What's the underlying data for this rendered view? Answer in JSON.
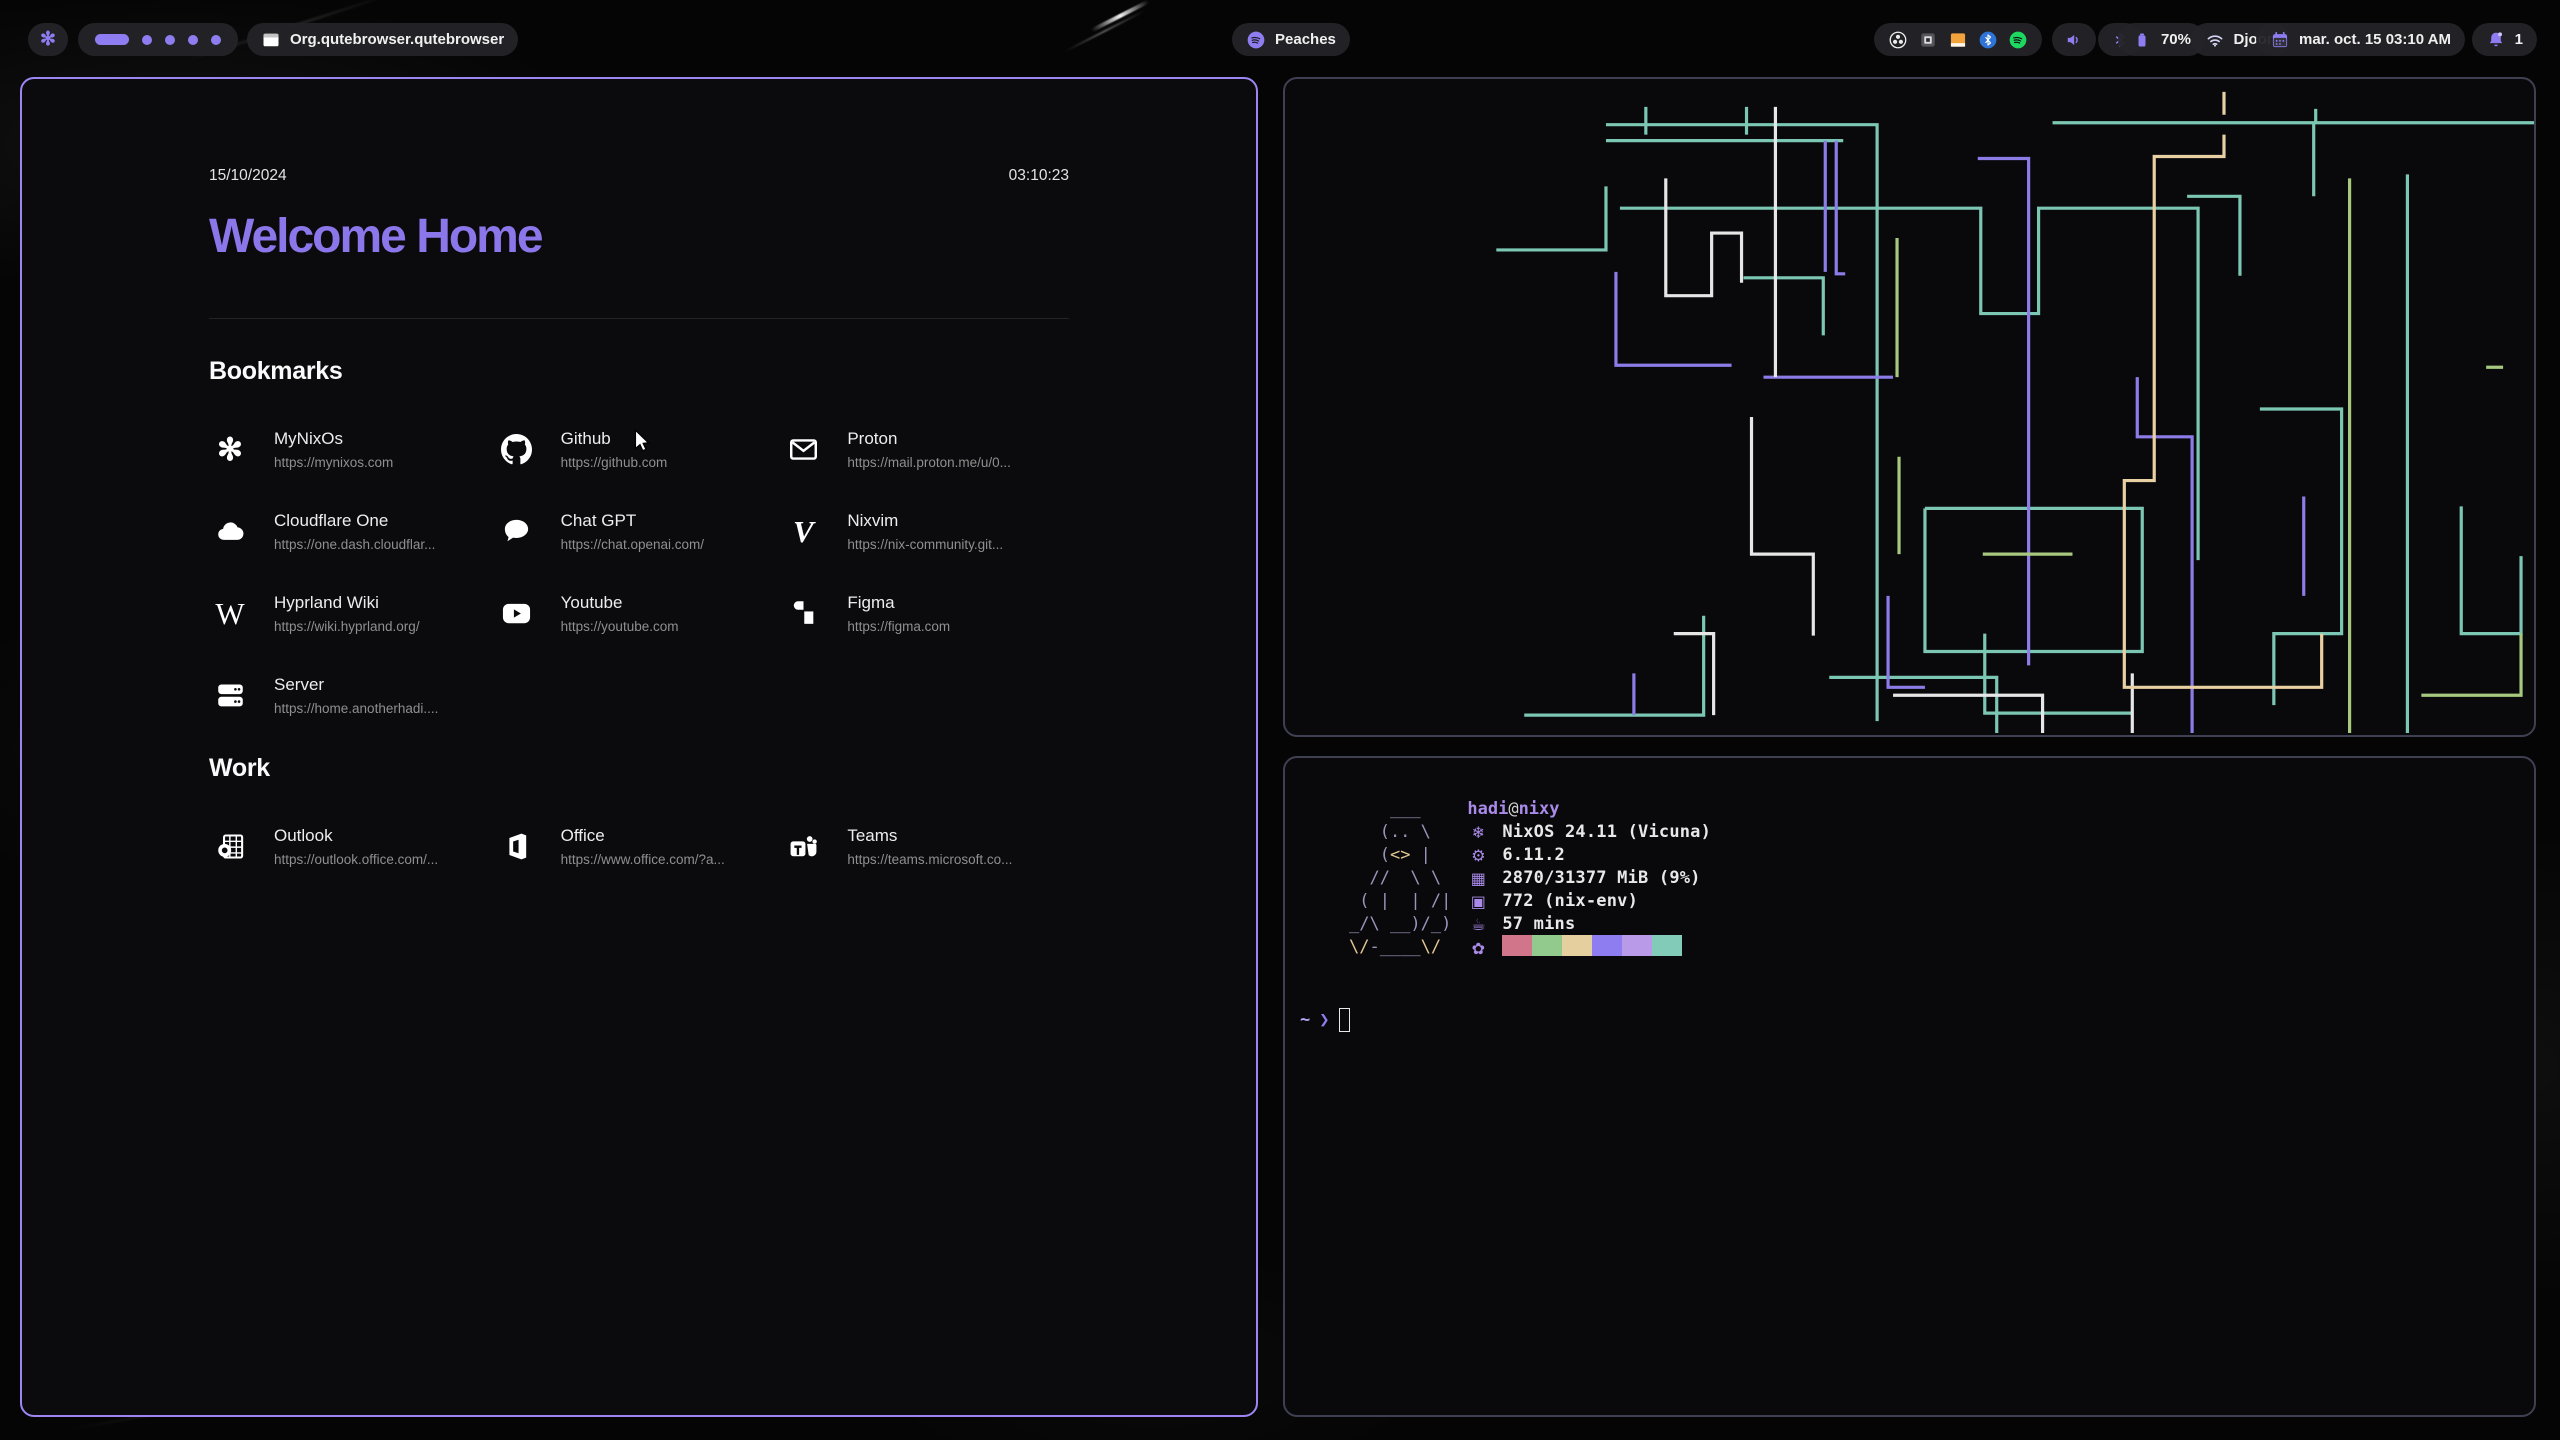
{
  "theme": {
    "accent": "#8d7df1",
    "title_purple": "#8b76ea",
    "window_border_active": "#9d86f3",
    "window_border_inactive": "#3f3f52",
    "pill_bg": "#242428",
    "pipe_colors": {
      "teal": "#7cc7b4",
      "purple": "#8b7ce8",
      "white": "#e6e6e6",
      "green": "#a6c97f",
      "tan": "#e8d0a2"
    }
  },
  "topbar": {
    "launcher": {
      "icon": "nixos-logo",
      "glyph": "✻"
    },
    "workspaces": {
      "active": 1,
      "total": 5
    },
    "window_title": "Org.qutebrowser.qutebrowser",
    "media": {
      "icon": "spotify",
      "label": "Peaches"
    },
    "tray": [
      "obs",
      "keyboard",
      "files",
      "bluetooth",
      "spotify"
    ],
    "battery": {
      "label": "70%"
    },
    "network": {
      "label": "Djoon"
    },
    "clock": {
      "label": "mar. oct. 15  03:10 AM"
    },
    "notifications": {
      "label": "1"
    }
  },
  "browser": {
    "date": "15/10/2024",
    "time": "03:10:23",
    "title": "Welcome Home",
    "sections": [
      {
        "title": "Bookmarks",
        "items": [
          {
            "name": "MyNixOs",
            "url": "https://mynixos.com",
            "icon": "nixos"
          },
          {
            "name": "Github",
            "url": "https://github.com",
            "icon": "github"
          },
          {
            "name": "Proton",
            "url": "https://mail.proton.me/u/0...",
            "icon": "envelope"
          },
          {
            "name": "Cloudflare One",
            "url": "https://one.dash.cloudflar...",
            "icon": "cloud"
          },
          {
            "name": "Chat GPT",
            "url": "https://chat.openai.com/",
            "icon": "chat-bubble"
          },
          {
            "name": "Nixvim",
            "url": "https://nix-community.git...",
            "icon": "nixvim-v"
          },
          {
            "name": "Hyprland Wiki",
            "url": "https://wiki.hyprland.org/",
            "icon": "wiki-w"
          },
          {
            "name": "Youtube",
            "url": "https://youtube.com",
            "icon": "youtube-play"
          },
          {
            "name": "Figma",
            "url": "https://figma.com",
            "icon": "figma"
          },
          {
            "name": "Server",
            "url": "https://home.anotherhadi....",
            "icon": "server"
          }
        ]
      },
      {
        "title": "Work",
        "items": [
          {
            "name": "Outlook",
            "url": "https://outlook.office.com/...",
            "icon": "outlook"
          },
          {
            "name": "Office",
            "url": "https://www.office.com/?a...",
            "icon": "office"
          },
          {
            "name": "Teams",
            "url": "https://teams.microsoft.co...",
            "icon": "teams"
          }
        ]
      }
    ]
  },
  "terminal": {
    "fetch": {
      "user": "hadi",
      "sep": "@",
      "host": "nixy",
      "rows": [
        {
          "key": "os",
          "icon": "❄",
          "text": "NixOS 24.11 (Vicuna)"
        },
        {
          "key": "kernel",
          "icon": "⚙",
          "text": "6.11.2"
        },
        {
          "key": "memory",
          "icon": "▦",
          "text": "2870/31377 MiB (9%)"
        },
        {
          "key": "packages",
          "icon": "▣",
          "text": "772 (nix-env)"
        },
        {
          "key": "uptime",
          "icon": "☕",
          "text": "57 mins"
        }
      ],
      "palette_icon": "✿",
      "palette": [
        "#d1758b",
        "#92c98c",
        "#e6cf9f",
        "#8d7df1",
        "#b89ae9",
        "#82cbb8"
      ],
      "ascii": [
        [
          {
            "t": "    ___",
            "c": "g"
          }
        ],
        [
          {
            "t": "   (.. \\",
            "c": "g"
          }
        ],
        [
          {
            "t": "   (",
            "c": "g"
          },
          {
            "t": "<>",
            "c": "y"
          },
          {
            "t": " |",
            "c": "g"
          }
        ],
        [
          {
            "t": "  //  \\ \\",
            "c": "g"
          }
        ],
        [
          {
            "t": " ( |  | /|",
            "c": "g"
          }
        ],
        [
          {
            "t": "_/\\ __)/_)",
            "c": "g"
          }
        ],
        [
          {
            "t": "\\/",
            "c": "y"
          },
          {
            "t": "-____",
            "c": "g"
          },
          {
            "t": "\\/",
            "c": "y"
          }
        ]
      ]
    },
    "prompt": {
      "path": "~",
      "symbol": "❯"
    }
  },
  "pipes": [
    {
      "c": "#7cc7b4",
      "d": "M322 46H594V646"
    },
    {
      "c": "#7cc7b4",
      "d": "M322 62H560"
    },
    {
      "c": "#7cc7b4",
      "d": "M212 172H322V108"
    },
    {
      "c": "#7cc7b4",
      "d": "M336 130H698V236H756V130H916V484"
    },
    {
      "c": "#7cc7b4",
      "d": "M770 44H1032V118"
    },
    {
      "c": "#7cc7b4",
      "d": "M1034 30V44H1432V598H1396V658"
    },
    {
      "c": "#7cc7b4",
      "d": "M1126 96V658"
    },
    {
      "c": "#7cc7b4",
      "d": "M978 332H1060V558H992V630"
    },
    {
      "c": "#7cc7b4",
      "d": "M1312 256V364H1384V256H1312"
    },
    {
      "c": "#7cc7b4",
      "d": "M642 432H860V576H642V432"
    },
    {
      "c": "#7cc7b4",
      "d": "M546 602H714V658"
    },
    {
      "c": "#7cc7b4",
      "d": "M702 558V638H850"
    },
    {
      "c": "#7cc7b4",
      "d": "M240 640H420V540"
    },
    {
      "c": "#7cc7b4",
      "d": "M460 200H540V258"
    },
    {
      "c": "#7cc7b4",
      "d": "M362 28V56"
    },
    {
      "c": "#7cc7b4",
      "d": "M463 28V56"
    },
    {
      "c": "#7cc7b4",
      "d": "M905 118H958V198"
    },
    {
      "c": "#7cc7b4",
      "d": "M1180 430V558H1240V480"
    },
    {
      "c": "#8b7ce8",
      "d": "M332 194V288H448"
    },
    {
      "c": "#8b7ce8",
      "d": "M542 62V194"
    },
    {
      "c": "#8b7ce8",
      "d": "M553 62V196H562"
    },
    {
      "c": "#8b7ce8",
      "d": "M695 80H746V590"
    },
    {
      "c": "#8b7ce8",
      "d": "M480 300H610"
    },
    {
      "c": "#8b7ce8",
      "d": "M855 300V360H910V658"
    },
    {
      "c": "#8b7ce8",
      "d": "M605 520V612H642"
    },
    {
      "c": "#8b7ce8",
      "d": "M1022 420V520"
    },
    {
      "c": "#8b7ce8",
      "d": "M350 598V640"
    },
    {
      "c": "#e6e6e6",
      "d": "M382 100V218H428V155H458V205"
    },
    {
      "c": "#e6e6e6",
      "d": "M492 28V300"
    },
    {
      "c": "#e6e6e6",
      "d": "M468 340V478H530V560"
    },
    {
      "c": "#e6e6e6",
      "d": "M610 620H760V658"
    },
    {
      "c": "#e6e6e6",
      "d": "M850 598V658"
    },
    {
      "c": "#e6e6e6",
      "d": "M390 558H430V640"
    },
    {
      "c": "#a6c97f",
      "d": "M614 160V300"
    },
    {
      "c": "#a6c97f",
      "d": "M616 380V478"
    },
    {
      "c": "#a6c97f",
      "d": "M1068 100V658"
    },
    {
      "c": "#a6c97f",
      "d": "M1205 290H1222"
    },
    {
      "c": "#a6c97f",
      "d": "M1140 620H1240V558"
    },
    {
      "c": "#a6c97f",
      "d": "M700 478H790"
    },
    {
      "c": "#e8d0a2",
      "d": "M942 13V36"
    },
    {
      "c": "#e8d0a2",
      "d": "M942 56V78H872V404H842V612H1040V558"
    }
  ]
}
